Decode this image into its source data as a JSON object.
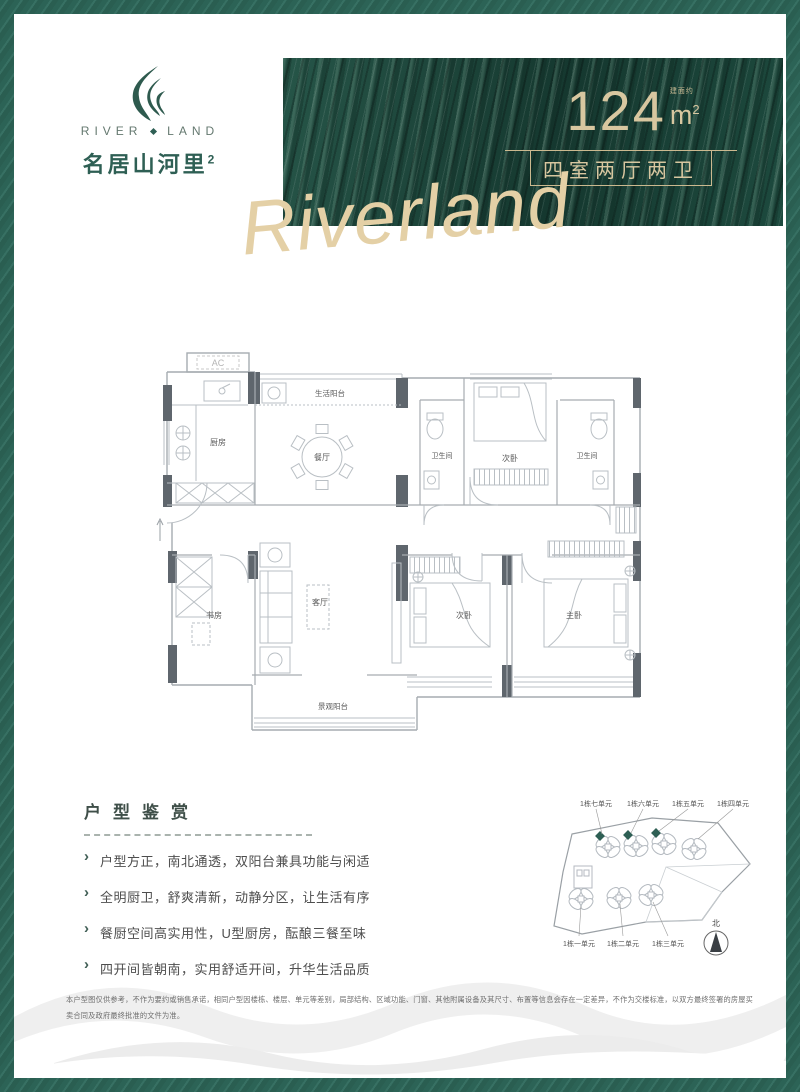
{
  "colors": {
    "brand_green": "#2e5f54",
    "banner_green": "#1c473c",
    "gold": "#d8c7a0",
    "wall_dark": "#5f666d",
    "text_gray": "#4e4e4e"
  },
  "logo": {
    "en_left": "RIVER",
    "en_right": "LAND",
    "cn_name": "名居山河里",
    "cn_sup": "2",
    "flame_icon": "flame-leaf-icon"
  },
  "banner": {
    "area_value": "124",
    "area_prefix": "建面约",
    "area_unit": "m",
    "area_unit_sup": "2",
    "layout_label": "四室两厅两卫",
    "script_text": "Riverland"
  },
  "floorplan": {
    "rooms": {
      "ac": "AC",
      "kitchen": "厨房",
      "service_balcony": "生活阳台",
      "dining": "餐厅",
      "bath1": "卫生间",
      "bedroom_top": "次卧",
      "bath2": "卫生间",
      "study": "书房",
      "living": "客厅",
      "bedroom_bottom": "次卧",
      "master": "主卧",
      "view_balcony": "景观阳台"
    }
  },
  "appreciation": {
    "title": "户型鉴赏",
    "points": [
      "户型方正，南北通透，双阳台兼具功能与闲适",
      "全明厨卫，舒爽清新，动静分区，让生活有序",
      "餐厨空间高实用性，U型厨房，酝酿三餐至味",
      "四开间皆朝南，实用舒适开间，升华生活品质"
    ]
  },
  "siteplan": {
    "top_labels": [
      "1栋七单元",
      "1栋六单元",
      "1栋五单元",
      "1栋四单元"
    ],
    "bottom_labels": [
      "1栋一单元",
      "1栋二单元",
      "1栋三单元"
    ],
    "north_label": "北",
    "highlight_color": "#2e5f54"
  },
  "disclaimer": {
    "text": "本户型图仅供参考，不作为要约或销售承诺，相同户型因楼栋、楼层、单元等差别，局部结构、区域功能、门窗、其他附属设备及其尺寸、布置等信息会存在一定差异，不作为交楼标准，以双方最终签署的房屋买卖合同及政府最终批准的文件为准。"
  }
}
